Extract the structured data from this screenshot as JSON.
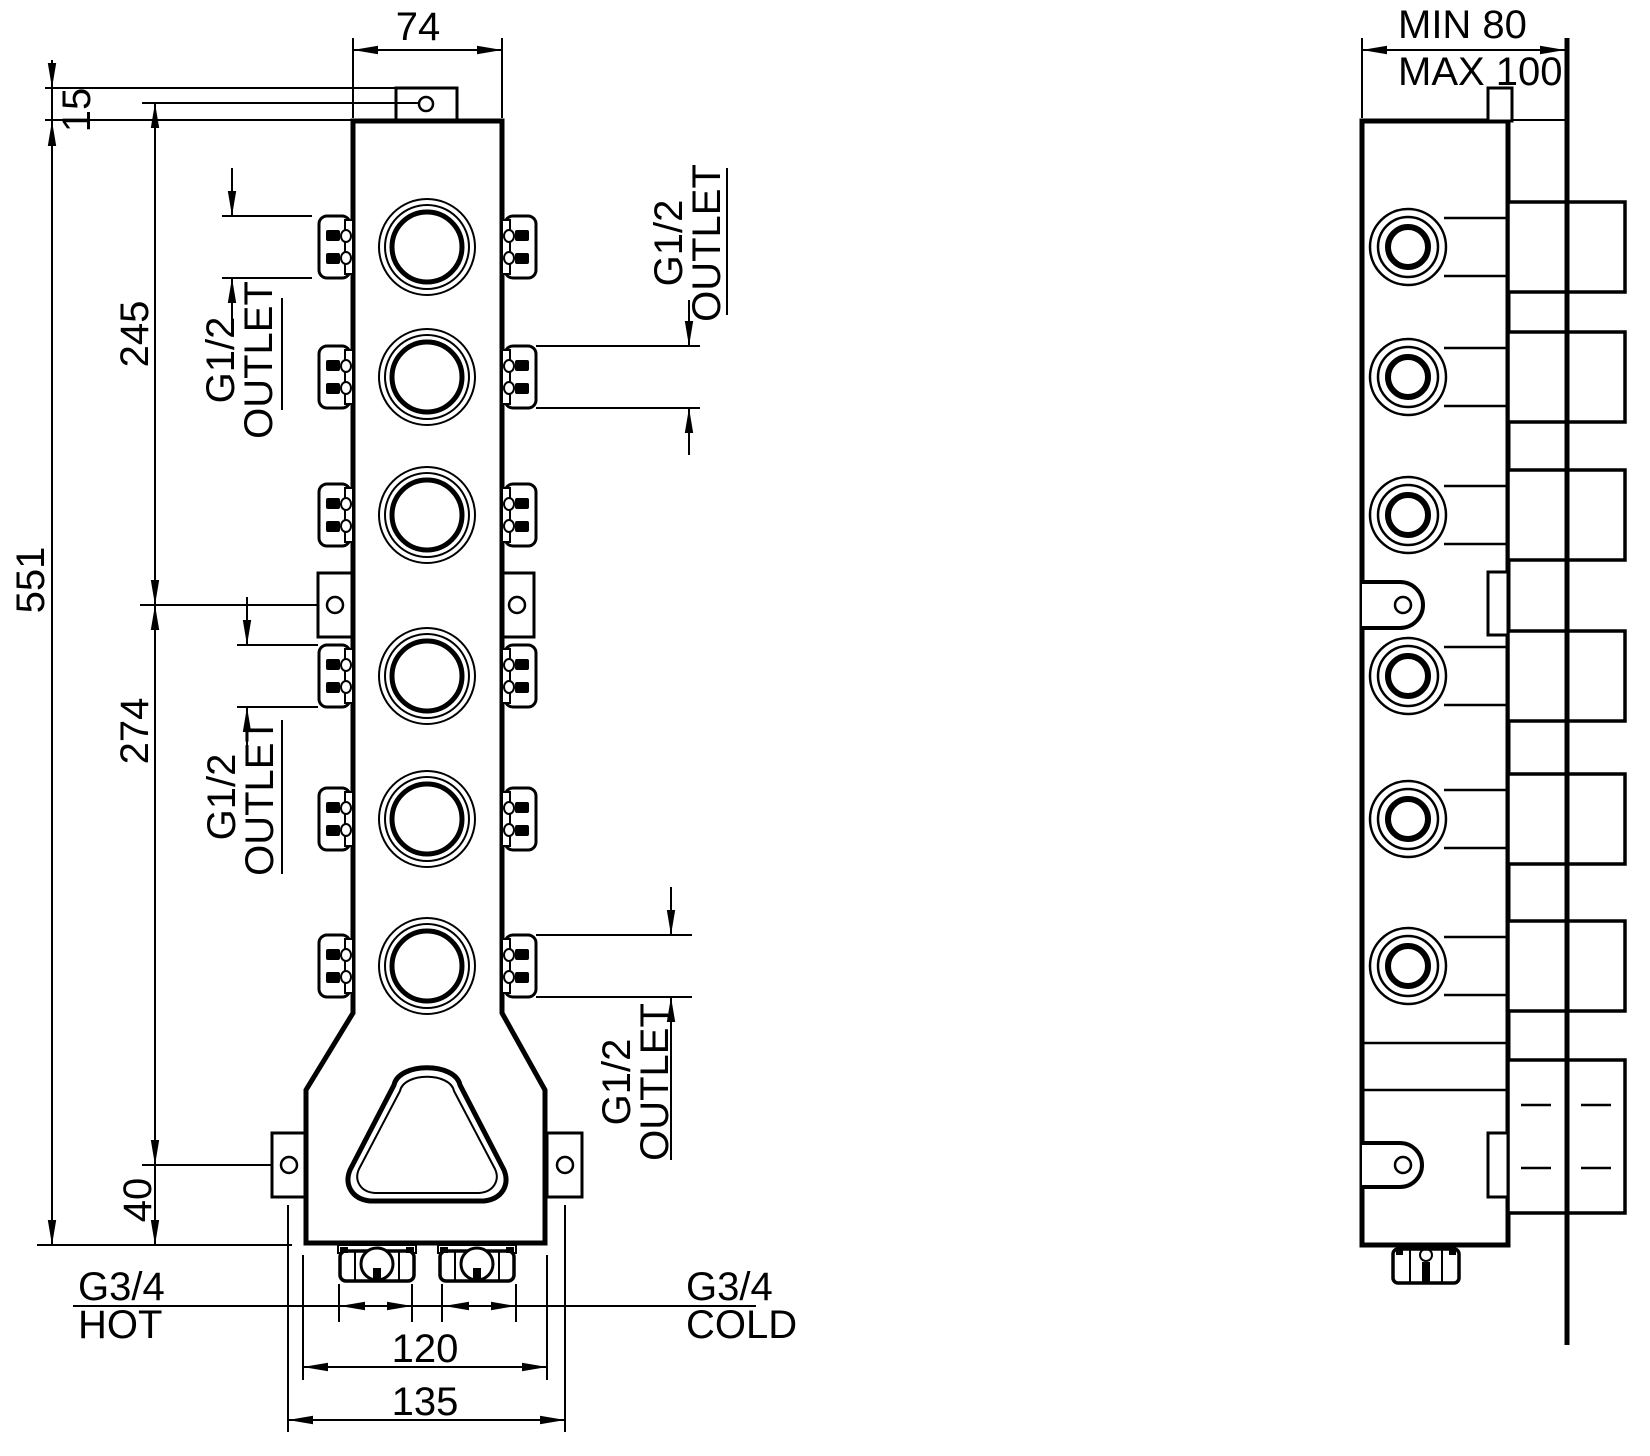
{
  "front_view": {
    "width_dim": "74",
    "tab_offset_dim": "15",
    "height_dim": "551",
    "upper_span_dim": "245",
    "lower_span_dim": "274",
    "base_offset_dim": "40",
    "inlet_span_dim": "120",
    "mount_span_dim": "135",
    "outlet_top_left": {
      "size": "G1/2",
      "label": "OUTLET"
    },
    "outlet_top_right": {
      "size": "G1/2",
      "label": "OUTLET"
    },
    "outlet_mid_left": {
      "size": "G1/2",
      "label": "OUTLET"
    },
    "outlet_bottom_right": {
      "size": "G1/2",
      "label": "OUTLET"
    },
    "inlet_hot": {
      "size": "G3/4",
      "label": "HOT"
    },
    "inlet_cold": {
      "size": "G3/4",
      "label": "COLD"
    }
  },
  "side_view": {
    "depth_min": "MIN 80",
    "depth_max": "MAX 100"
  },
  "colors": {
    "line": "#000000",
    "background": "#ffffff"
  }
}
